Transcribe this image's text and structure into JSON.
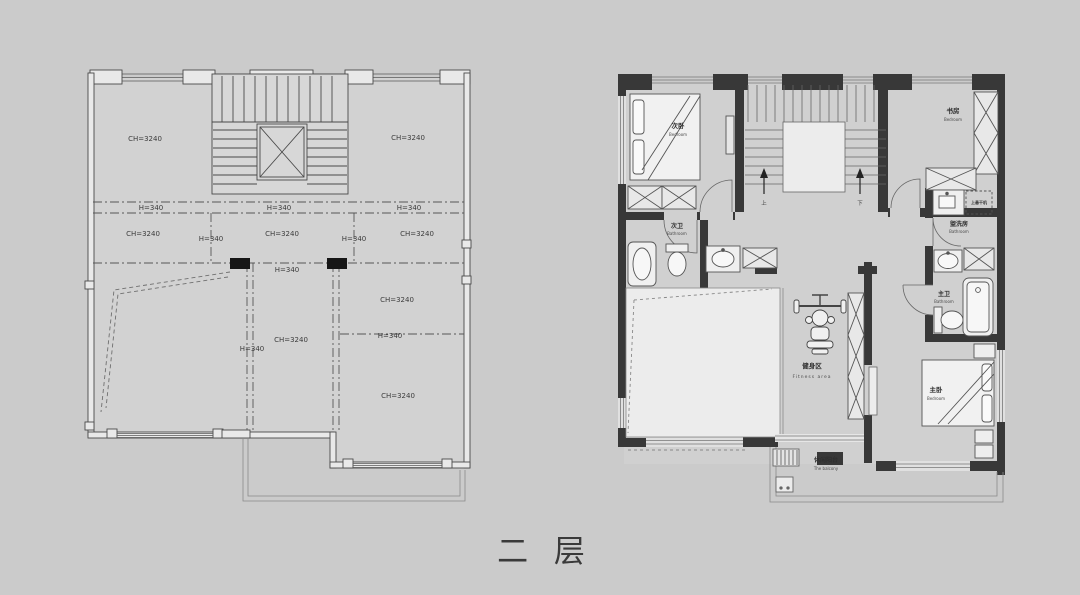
{
  "title": {
    "floor_label": "二 层"
  },
  "left_plan": {
    "labels": [
      "CH=3240",
      "CH=3240",
      "H=340",
      "H=340",
      "H=340",
      "CH=3240",
      "CH=3240",
      "CH=3240",
      "H=340",
      "H=340",
      "H=340",
      "CH=3240",
      "H=340",
      "CH=3240",
      "H=340",
      "CH=3240"
    ]
  },
  "right_plan": {
    "rooms": {
      "bedroom2": {
        "cn": "次卧",
        "en": "Bedroom"
      },
      "study": {
        "cn": "书房",
        "en": "Bedroom"
      },
      "bath2": {
        "cn": "次卫",
        "en": "Bathroom"
      },
      "washroom": {
        "cn": "盥洗房",
        "en": "Bathroom"
      },
      "dryer_note": {
        "cn": "上悬干机"
      },
      "master_bath": {
        "cn": "主卫",
        "en": "Bathroom"
      },
      "master_bedroom": {
        "cn": "主卧",
        "en": "Bedroom"
      },
      "fitness": {
        "cn": "健身区",
        "en": "Fitness area"
      },
      "balcony": {
        "cn": "休闲阳台",
        "en": "The balcony"
      }
    },
    "stairs": {
      "up": "上",
      "down": "下"
    }
  },
  "colors": {
    "background": "#cbcbcb",
    "wall_dark": "#383838",
    "cad_line": "#4a4a4a",
    "room_fill": "#d2d2d2",
    "void_fill": "#ececec"
  }
}
